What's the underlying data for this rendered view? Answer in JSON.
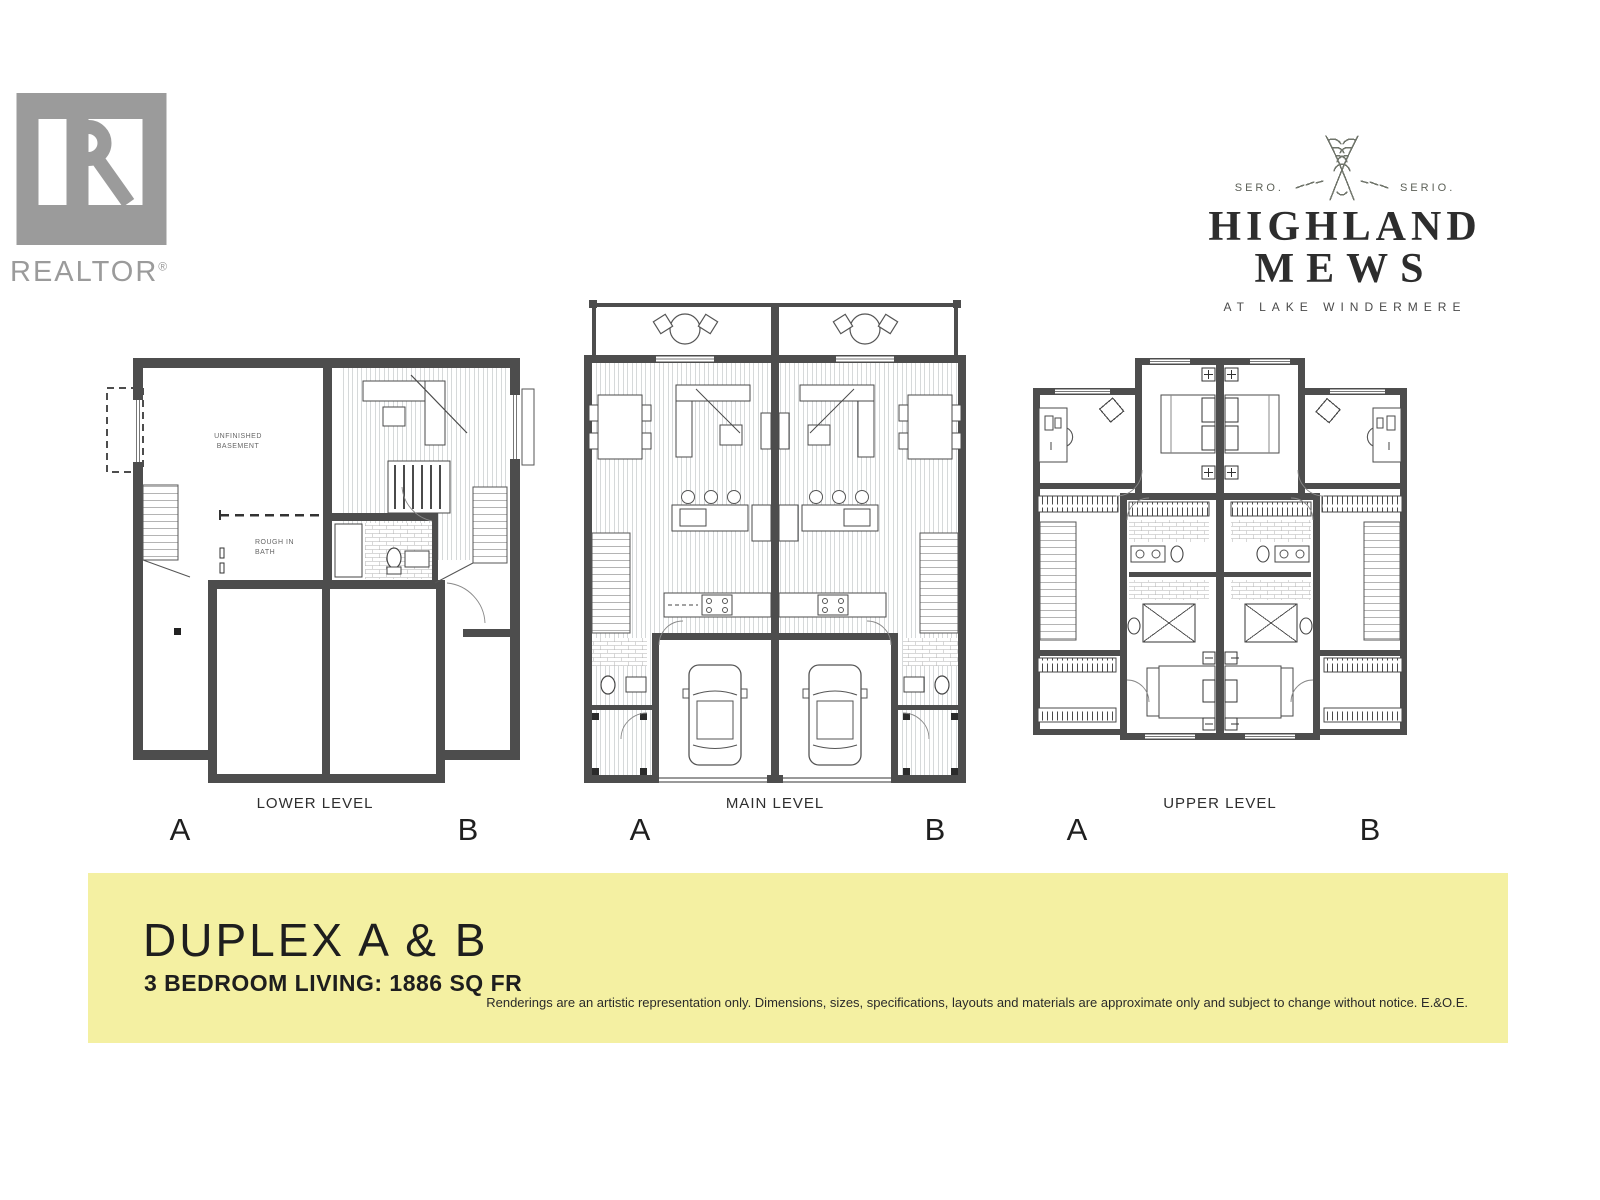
{
  "realtor_logo": {
    "label": "REALTOR",
    "registered": "®",
    "color": "#9b9b9b"
  },
  "brand": {
    "motto_left": "SERO.",
    "motto_right": "SERIO.",
    "name_line1": "HIGHLAND",
    "name_line2": "MEWS",
    "tagline": "AT LAKE WINDERMERE",
    "ink": "#2d2d2d"
  },
  "plans": [
    {
      "label": "LOWER LEVEL",
      "unit_left": "A",
      "unit_right": "B",
      "rooms": {
        "basement_line1": "UNFINISHED",
        "basement_line2": "BASEMENT",
        "bath_line1": "ROUGH IN",
        "bath_line2": "BATH"
      }
    },
    {
      "label": "MAIN LEVEL",
      "unit_left": "A",
      "unit_right": "B"
    },
    {
      "label": "UPPER LEVEL",
      "unit_left": "A",
      "unit_right": "B"
    }
  ],
  "banner": {
    "bg": "#f4f0a2",
    "title": "DUPLEX A & B",
    "subtitle": "3 BEDROOM LIVING: 1886 SQ FR",
    "disclaimer": "Renderings are an artistic representation only. Dimensions, sizes, specifications, layouts and materials are approximate only and subject to change without notice. E.&O.E."
  },
  "colors": {
    "wall": "#4d4d4d",
    "line": "#3c3c3c",
    "floor_hatch": "#9aa0a4",
    "logo_gray": "#9b9b9b"
  }
}
